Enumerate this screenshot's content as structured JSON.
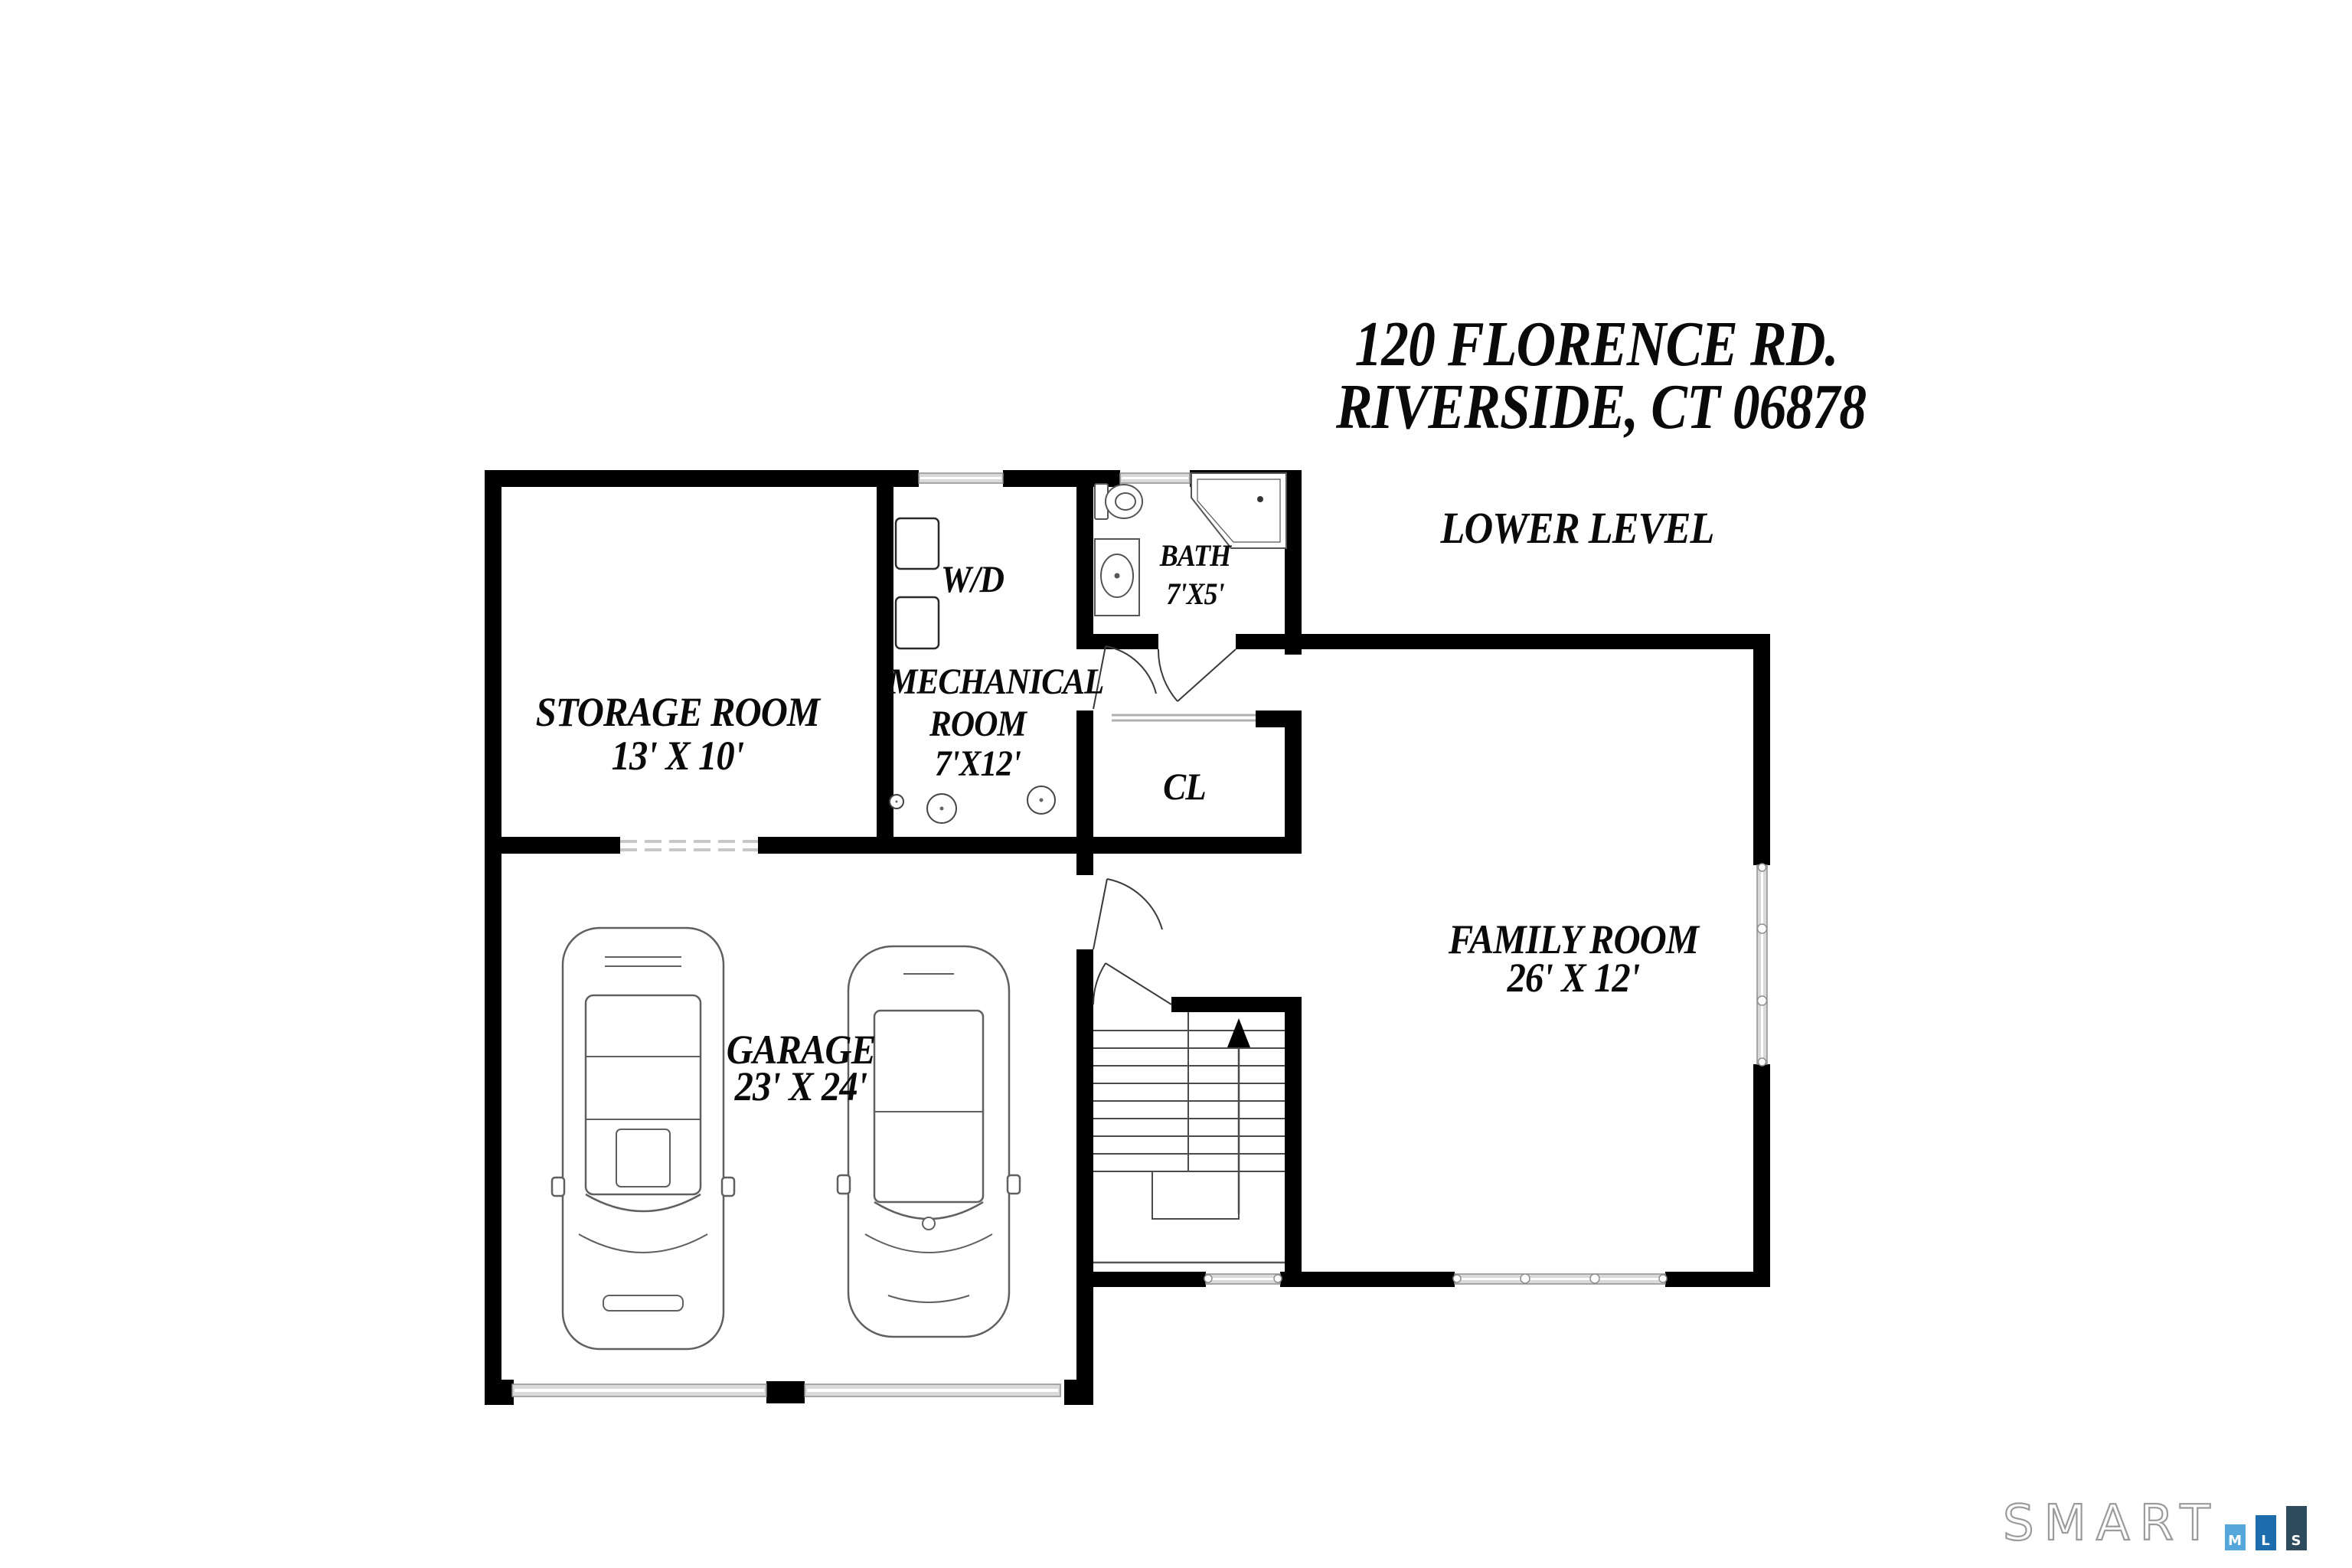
{
  "title": {
    "line1": "120 FLORENCE RD.",
    "line2": "RIVERSIDE, CT 06878"
  },
  "level_label": "LOWER LEVEL",
  "rooms": {
    "storage": {
      "name": "STORAGE ROOM",
      "dims": "13' X 10'"
    },
    "mechanical": {
      "line1": "MECHANICAL",
      "line2": "ROOM",
      "dims": "7'X12'"
    },
    "bath": {
      "name": "BATH",
      "dims": "7'X5'"
    },
    "closet": {
      "name": "CL"
    },
    "garage": {
      "name": "GARAGE",
      "dims": "23' X 24'"
    },
    "family": {
      "name": "FAMILY ROOM",
      "dims": "26' X 12'"
    }
  },
  "labels": {
    "washer_dryer": "W/D"
  },
  "logo": {
    "word": "SMART",
    "m": "M",
    "l": "L",
    "s": "S"
  },
  "colors": {
    "wall": "#000000",
    "window_fill": "#d9d9d9",
    "logo_m_blue": "#55a7db",
    "logo_l_blue": "#1d6cae",
    "logo_s_slate": "#2e4a5d",
    "logo_outline_gray": "#9b9b9b"
  }
}
